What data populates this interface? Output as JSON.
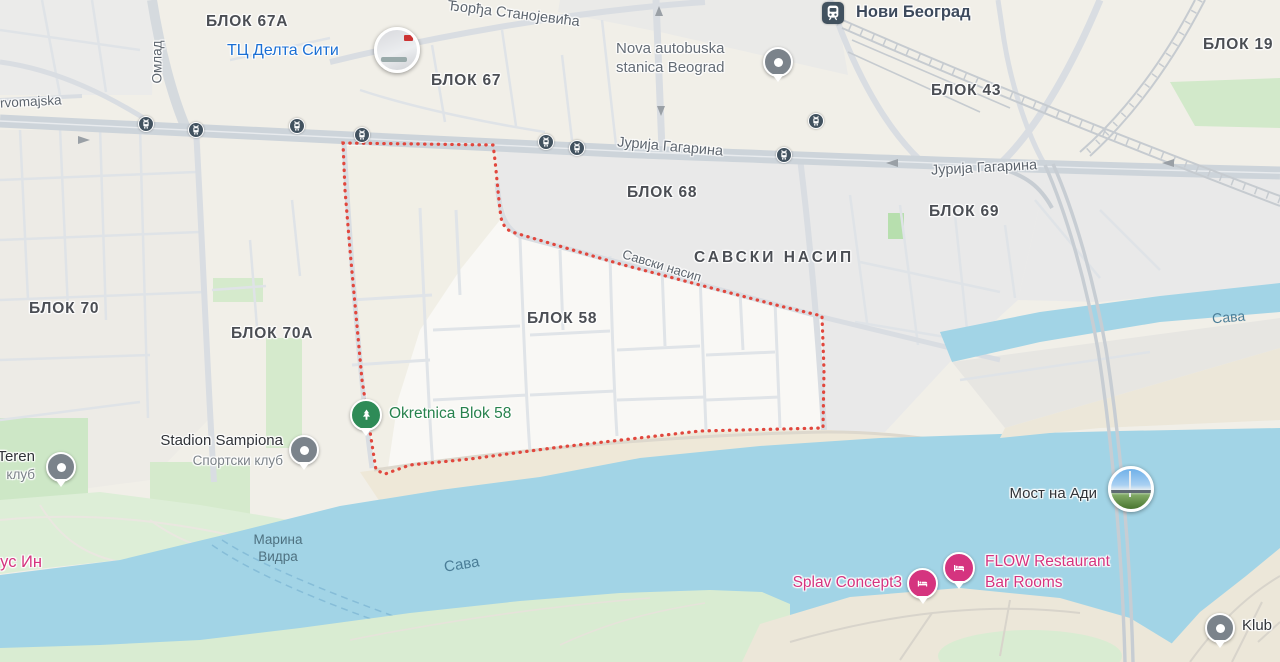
{
  "map_context": "Google-Maps style view of Novi Beograd blocks along the Sava river with Blok 58 outlined",
  "colors": {
    "land": "#f1efe8",
    "urban_gray": "#e9e9e9",
    "water": "#a2d4e6",
    "park_green": "#cde7c6",
    "bank_green": "#ddeed7",
    "sand": "#eee8d8",
    "road": "#d9dde2",
    "main_road": "#cdd4da",
    "railway": "#c6cbd0",
    "boundary_red": "#e1473d",
    "poi_blue": "#1a6fd4",
    "poi_green": "#27824d",
    "poi_pink": "#d5347f",
    "transit_slate": "#42525f",
    "pin_gray": "#7b838b"
  },
  "areas": {
    "blok67a": "БЛОК 67А",
    "blok67": "БЛОК 67",
    "blok19": "БЛОК 19",
    "blok43": "БЛОК 43",
    "blok68": "БЛОК 68",
    "blok69": "БЛОК 69",
    "blok58": "БЛОК 58",
    "blok70": "БЛОК 70",
    "blok70a": "БЛОК 70А",
    "savski_nasip": "САВСКИ НАСИП"
  },
  "streets": {
    "djordja_stanojevica": "Ђорђа Станојевића",
    "jurija_gagarina": "Јурија Гагарина",
    "savski_nasip_road": "Савски насип",
    "omladinskih": "Омлад",
    "prvomajska": "rvomajska"
  },
  "water": {
    "sava": "Сава",
    "marina_line1": "Марина",
    "marina_line2": "Видра"
  },
  "transit": {
    "station_novi_beograd": "Нови Београд"
  },
  "pois": {
    "delta_city": "ТЦ Делта Сити",
    "bus_station_line1": "Nova autobuska",
    "bus_station_line2": "stanica Beograd",
    "okretnica": "Okretnica Blok 58",
    "stadion": "Stadion Sampiona",
    "stadion_sub": "Спортски клуб",
    "teren": "Teren",
    "teren_sub": "клуб",
    "most_na_adi": "Мост на Ади",
    "flow_line1": "FLOW Restaurant",
    "flow_line2": "Bar Rooms",
    "splav": "Splav Concept3",
    "us_in": "ус Ин",
    "klub": "Klub"
  }
}
